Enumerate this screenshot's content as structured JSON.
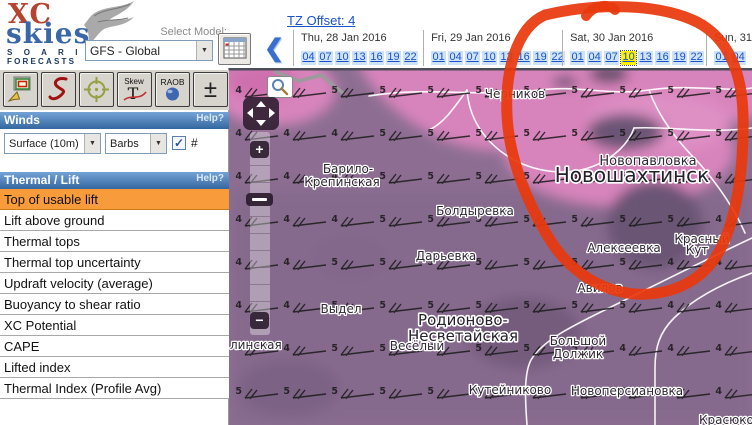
{
  "colors": {
    "accent_orange": "#f89b3a",
    "header_blue_light": "#74a3d6",
    "header_blue_dark": "#34679f",
    "link_blue": "#1a52c8",
    "time_cell_bg": "#cfe3f7",
    "selected_time_bg": "#fff000",
    "annotation_red": "#e8390e",
    "map_base": "#8d6e92",
    "map_pink": "#d884bc",
    "map_dark": "#6b5574",
    "logo_red": "#b5432f",
    "logo_blue": "#3a67a8"
  },
  "logo": {
    "xc": "XC",
    "skies": "skies",
    "soaring": "S O A R I N G",
    "forecasts": "FORECASTS"
  },
  "model": {
    "label": "Select Model:",
    "value": "GFS - Global"
  },
  "tz": {
    "label": "TZ Offset: 4"
  },
  "nav": {
    "back_icon": "❮"
  },
  "dates": {
    "columns": [
      {
        "label": "Thu, 28 Jan 2016",
        "times": [
          "04",
          "07",
          "10",
          "13",
          "16",
          "19",
          "22"
        ],
        "selected": ""
      },
      {
        "label": "Fri, 29 Jan 2016",
        "times": [
          "01",
          "04",
          "07",
          "10",
          "13",
          "16",
          "19",
          "22"
        ],
        "selected": ""
      },
      {
        "label": "Sat, 30 Jan 2016",
        "times": [
          "01",
          "04",
          "07",
          "10",
          "13",
          "16",
          "19",
          "22"
        ],
        "selected": "10"
      },
      {
        "label": "Sun, 31",
        "times": [
          "01",
          "04"
        ],
        "selected": ""
      }
    ]
  },
  "toolbar": {
    "button_icons": [
      "select-area",
      "draw-route",
      "crosshair-target",
      "skew-t-sounding",
      "raob-sounding",
      "adjust-levels"
    ],
    "skew_top": "Skew",
    "skew_main": "T",
    "raob": "RAOB",
    "plus_minus": "±"
  },
  "winds": {
    "title": "Winds",
    "help": "Help?",
    "level": "Surface (10m)",
    "style": "Barbs",
    "numbers_label": "#",
    "numbers_checked": true
  },
  "thermal": {
    "title": "Thermal / Lift",
    "help": "Help?",
    "selected_index": 0,
    "items": [
      "Top of usable lift",
      "Lift above ground",
      "Thermal tops",
      "Thermal top uncertainty",
      "Updraft velocity (average)",
      "Buoyancy to shear ratio",
      "XC Potential",
      "CAPE",
      "Lifted index",
      "Thermal Index (Profile Avg)"
    ]
  },
  "map": {
    "labels": [
      {
        "text": "Черников",
        "x": 286,
        "y": 30,
        "size": 12
      },
      {
        "text": "Новопавловка",
        "x": 419,
        "y": 97,
        "size": 13
      },
      {
        "text": "Новошахтинск",
        "x": 403,
        "y": 114,
        "size": 20,
        "big": true
      },
      {
        "text": "Барило-",
        "x": 119,
        "y": 105,
        "size": 12
      },
      {
        "text": "Крепинская",
        "x": 113,
        "y": 118,
        "size": 12
      },
      {
        "text": "Болдыревка",
        "x": 246,
        "y": 147,
        "size": 12
      },
      {
        "text": "Дарьевка",
        "x": 217,
        "y": 192,
        "size": 12
      },
      {
        "text": "Алексеевка",
        "x": 395,
        "y": 184,
        "size": 12
      },
      {
        "text": "Красный",
        "x": 473,
        "y": 175,
        "size": 12
      },
      {
        "text": "Кут",
        "x": 468,
        "y": 186,
        "size": 12
      },
      {
        "text": "Авилов",
        "x": 371,
        "y": 224,
        "size": 12
      },
      {
        "text": "Выдел",
        "x": 112,
        "y": 245,
        "size": 12
      },
      {
        "text": "Родионово-",
        "x": 234,
        "y": 257,
        "size": 15,
        "big": true
      },
      {
        "text": "Несветайская",
        "x": 234,
        "y": 273,
        "size": 15,
        "big": true
      },
      {
        "text": "Весёлый",
        "x": 188,
        "y": 282,
        "size": 12
      },
      {
        "text": "Большой",
        "x": 349,
        "y": 277,
        "size": 12
      },
      {
        "text": "Должик",
        "x": 349,
        "y": 290,
        "size": 12
      },
      {
        "text": "Кутейниково",
        "x": 281,
        "y": 326,
        "size": 12
      },
      {
        "text": "Новоперсиановка",
        "x": 398,
        "y": 327,
        "size": 12
      },
      {
        "text": "Красюковская",
        "x": 470,
        "y": 356,
        "size": 12,
        "anchor": "start"
      },
      {
        "text": "линская",
        "x": 1,
        "y": 281,
        "size": 12,
        "anchor": "start"
      }
    ],
    "wind_barbs": {
      "cols_x": [
        18,
        66,
        114,
        162,
        210,
        258,
        306,
        354,
        402,
        450,
        498
      ],
      "rows_y": [
        22,
        65,
        108,
        151,
        194,
        237,
        280,
        323
      ],
      "rows": [
        [
          "4",
          "4",
          "5",
          "5",
          "5",
          "5",
          "5",
          "5",
          "5",
          "5",
          "5"
        ],
        [
          "4",
          "4",
          "4",
          "5",
          "5",
          "5",
          "5",
          "5",
          "5",
          "5",
          "5"
        ],
        [
          "4",
          "4",
          "4",
          "5",
          "5",
          "5",
          "5",
          "5",
          "5",
          "5",
          "4"
        ],
        [
          "4",
          "4",
          "4",
          "5",
          "5",
          "5",
          "5",
          "5",
          "5",
          "5",
          "4"
        ],
        [
          "4",
          "4",
          "5",
          "5",
          "5",
          "5",
          "5",
          "5",
          "5",
          "4",
          "4"
        ],
        [
          "4",
          "4",
          "5",
          "5",
          "5",
          "5",
          "5",
          "5",
          "5",
          "4",
          "4"
        ],
        [
          "4",
          "4",
          "5",
          "5",
          "5",
          "5",
          "5",
          "5",
          "4",
          "4",
          "4"
        ],
        [
          "5",
          "5",
          "5",
          "5",
          "5",
          "5",
          "5",
          "5",
          "4",
          "4",
          "4"
        ]
      ]
    },
    "zoom_in_label": "+",
    "zoom_out_label": "−"
  }
}
